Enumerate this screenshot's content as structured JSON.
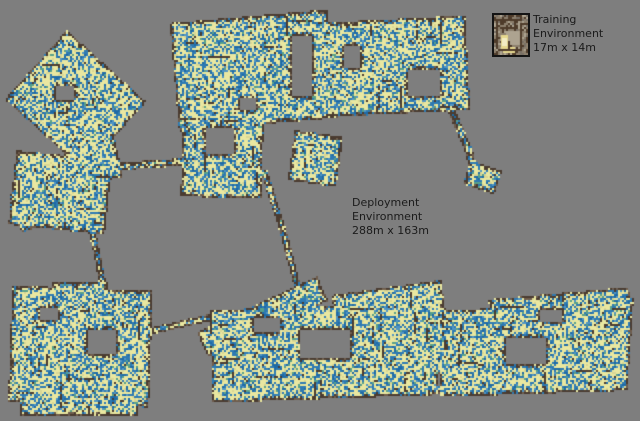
{
  "figure": {
    "training": {
      "line1": "Training",
      "line2": "Environment",
      "line3": "17m x 14m"
    },
    "deployment": {
      "line1": "Deployment",
      "line2": "Environment",
      "line3": "288m x 163m"
    }
  },
  "palette": {
    "background": "#7e7e7e",
    "free_yellow": "#e9e7a0",
    "yellow_dim": "#d9d694",
    "frontier_blue": "#2e7ab2",
    "blue_dark": "#1e6aa6",
    "blue_light": "#5095c4",
    "teal": "#58a08a",
    "wall_dark": "#4a3b30",
    "wall_light": "#6f5d4d",
    "label_color": "#1b1b1b",
    "thumb_base": "#8c7f6d",
    "thumb_wall": "#4e3b2a",
    "thumb_light": "#ada390",
    "thumb_yellow": "#e6d88e",
    "thumb_bright": "#f3ecc3",
    "thumb_border": "#141414"
  },
  "map": {
    "seed": 1337,
    "cell": 2,
    "width": 640,
    "height": 421,
    "shapes": [
      {
        "t": "r",
        "cx": 75,
        "cy": 100,
        "w": 106,
        "h": 92,
        "rot": 42
      },
      {
        "t": "r",
        "cx": 92,
        "cy": 160,
        "w": 52,
        "h": 44,
        "rot": -12
      },
      {
        "t": "r",
        "cx": 60,
        "cy": 192,
        "w": 96,
        "h": 74,
        "rot": 6
      },
      {
        "t": "r",
        "cx": 38,
        "cy": 205,
        "w": 48,
        "h": 40,
        "rot": -18
      },
      {
        "t": "l",
        "pts": [
          [
            115,
            166
          ],
          [
            192,
            161
          ]
        ],
        "w": 7
      },
      {
        "t": "l",
        "pts": [
          [
            84,
            200
          ],
          [
            96,
            250
          ],
          [
            103,
            288
          ]
        ],
        "w": 6
      },
      {
        "t": "r",
        "cx": 253,
        "cy": 70,
        "w": 158,
        "h": 108,
        "rot": -5
      },
      {
        "t": "r",
        "cx": 392,
        "cy": 66,
        "w": 150,
        "h": 94,
        "rot": -3
      },
      {
        "t": "r",
        "cx": 222,
        "cy": 148,
        "w": 80,
        "h": 98,
        "rot": 2
      },
      {
        "t": "r",
        "cx": 315,
        "cy": 158,
        "w": 48,
        "h": 50,
        "rot": 8
      },
      {
        "t": "l",
        "pts": [
          [
            452,
            112
          ],
          [
            468,
            150
          ],
          [
            474,
            172
          ]
        ],
        "w": 7
      },
      {
        "t": "r",
        "cx": 482,
        "cy": 177,
        "w": 32,
        "h": 24,
        "rot": 18
      },
      {
        "t": "l",
        "pts": [
          [
            264,
            172
          ],
          [
            283,
            232
          ],
          [
            298,
            290
          ]
        ],
        "w": 6
      },
      {
        "t": "r",
        "cx": 80,
        "cy": 346,
        "w": 140,
        "h": 116,
        "rot": 2
      },
      {
        "t": "r",
        "cx": 78,
        "cy": 402,
        "w": 118,
        "h": 28,
        "rot": 0
      },
      {
        "t": "r",
        "cx": 80,
        "cy": 291,
        "w": 56,
        "h": 18,
        "rot": 0
      },
      {
        "t": "l",
        "pts": [
          [
            144,
            332
          ],
          [
            210,
            317
          ]
        ],
        "w": 6
      },
      {
        "t": "r",
        "cx": 262,
        "cy": 316,
        "w": 132,
        "h": 26,
        "rot": -25
      },
      {
        "t": "r",
        "cx": 324,
        "cy": 352,
        "w": 226,
        "h": 92,
        "rot": -2
      },
      {
        "t": "r",
        "cx": 390,
        "cy": 316,
        "w": 110,
        "h": 58,
        "rot": -8
      },
      {
        "t": "r",
        "cx": 532,
        "cy": 350,
        "w": 188,
        "h": 86,
        "rot": -2
      },
      {
        "t": "r",
        "cx": 560,
        "cy": 314,
        "w": 140,
        "h": 42,
        "rot": -5
      },
      {
        "t": "r",
        "cx": 612,
        "cy": 338,
        "w": 36,
        "h": 84,
        "rot": 4
      }
    ],
    "holes": [
      [
        292,
        36,
        20,
        60
      ],
      [
        344,
        46,
        16,
        22
      ],
      [
        408,
        70,
        32,
        26
      ],
      [
        205,
        127,
        28,
        26
      ],
      [
        240,
        98,
        16,
        12
      ],
      [
        55,
        85,
        18,
        14
      ],
      [
        88,
        330,
        28,
        24
      ],
      [
        40,
        308,
        18,
        12
      ],
      [
        300,
        330,
        50,
        28
      ],
      [
        253,
        318,
        26,
        14
      ],
      [
        505,
        338,
        40,
        26
      ],
      [
        540,
        310,
        22,
        12
      ]
    ],
    "thumb": {
      "w": 34,
      "h": 40,
      "light_rect": [
        12,
        16,
        16,
        14
      ],
      "yellow_rect": [
        7,
        20,
        7,
        16
      ],
      "yellow_rect2": [
        9,
        32,
        12,
        6
      ],
      "bright_rect": [
        8,
        23,
        5,
        8
      ]
    }
  }
}
